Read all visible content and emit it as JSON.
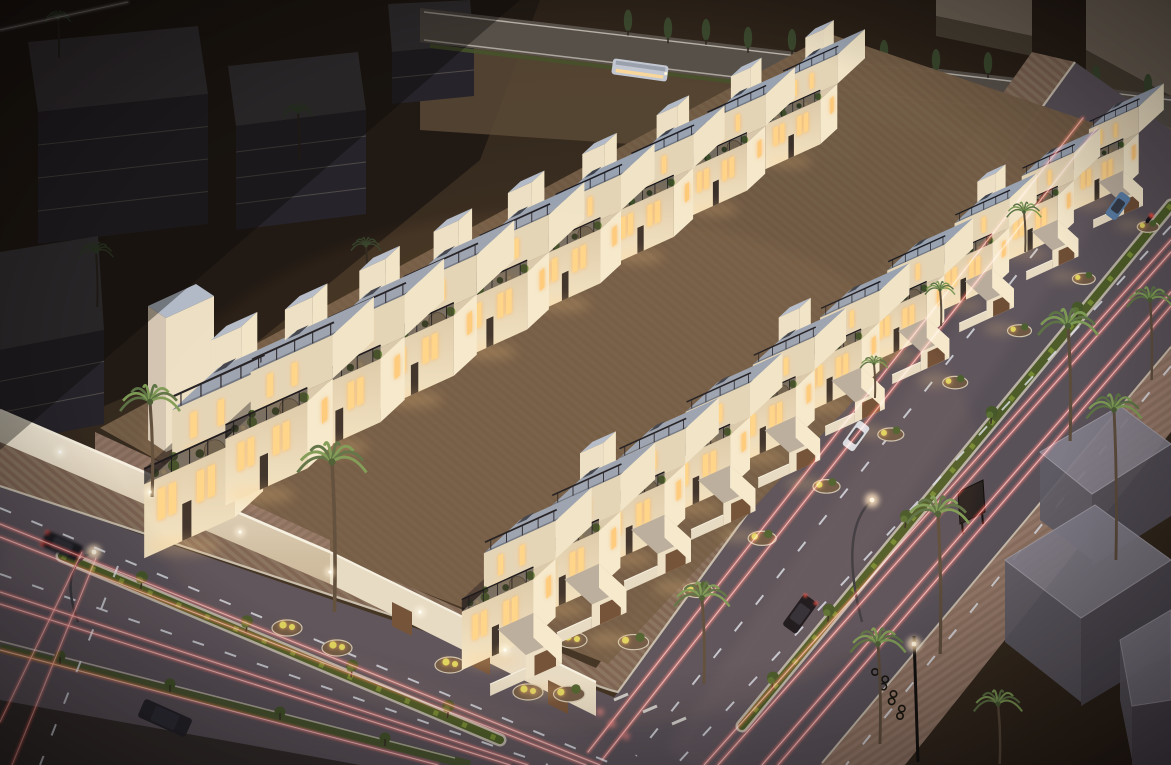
{
  "scene": {
    "label": "Twilight aerial 3D architectural rendering of a white villa townhouse compound with rooftop terraces, palm-lined streets and long-exposure traffic light trails",
    "width": 1171,
    "height": 765,
    "palette": {
      "night": "#17110d",
      "groundWarm": "#463626",
      "groundEdge": "#1a130e",
      "sandTop": "#5c4b37",
      "sandRight": "#392d21",
      "darkCorner": "#1f1913",
      "asphalt": "#595158",
      "asphaltLight": "#6e6268",
      "curb": "#cfc6b6",
      "pav1a": "#7a6151",
      "pav1b": "#85705d",
      "pav2a": "#8a6f5f",
      "pav2b": "#95796a",
      "grass": "#4d5c28",
      "grassLit": "#7c9136",
      "grassCurb": "#b9b2a4",
      "roof": "#99a2b0",
      "roofEdge": "#6e7682",
      "towerTop": "#b2bac7",
      "faceLit": "#ecdfc4",
      "faceMid": "#e4d4b6",
      "sideBright": "#f0e3c6",
      "sideBright2": "#f5e8cb",
      "terrace": "#d8c7aa",
      "wallTop": "#f6efdf",
      "wallFace": "#e7dac2",
      "window": "#ffd488",
      "windowSoft": "#ffc97a",
      "glow": "#ffd9a0",
      "garage": "#6f4e36",
      "entTop": "#b9ac9c",
      "soil": "#6e5844",
      "shrub": "#ded45c",
      "leaf": "#4c612f",
      "leafLit": "#6d8a3d",
      "palmLeaf": "#5d7345",
      "palmLeafLit": "#7d9a55",
      "palmTrunk": "#5c4c3c",
      "palmDark": "#31402a",
      "palmTrunkDark": "#2a241e",
      "cypress": "#39462c",
      "trailRed": "#ff4338",
      "trailCore": "#ffe0d6",
      "trailWhite": "#dfe3ea",
      "bgTop": "#3a373c",
      "bgFront": "#26232a",
      "bgLine": "#5e5952",
      "bgTop2": "#6b6154",
      "bgFront2": "#453d31",
      "ghostTop": "#827e8a",
      "ghostL": "#605c66",
      "ghostF": "#524e58",
      "ghostEdge": "#a09ca6",
      "busBody": "#c2c7d1",
      "busRoof": "#9aa1ad",
      "umbrella": "#c9ae85",
      "carBlack": "#17161b",
      "carWhite": "#d8dade",
      "carBlue": "#5a7ea6",
      "carDark": "#1c1b21",
      "truck": "#26242a"
    },
    "villa_rows": {
      "left": {
        "count": 8,
        "x0": 292,
        "y0": 334,
        "dx": 74,
        "dy": -40,
        "s0": 1.28,
        "ds": -0.06,
        "entrance": false
      },
      "right": {
        "count": 10,
        "x0": 520,
        "y0": 520,
        "dx": 66,
        "dy": -46,
        "s0": 1.12,
        "ds": -0.038,
        "entrance": true
      }
    },
    "corner_villa": {
      "x": 218,
      "y": 368,
      "s": 1.42
    },
    "palms": {
      "compound": [
        [
          150,
          402,
          26,
          95
        ],
        [
          332,
          462,
          30,
          150
        ],
        [
          702,
          598,
          24,
          86
        ],
        [
          1024,
          212,
          15,
          40
        ],
        [
          940,
          290,
          13,
          36
        ],
        [
          874,
          364,
          12,
          34
        ]
      ],
      "right_sidewalk": [
        [
          1068,
          326,
          26,
          115
        ],
        [
          1114,
          410,
          24,
          150
        ],
        [
          938,
          514,
          27,
          140
        ],
        [
          878,
          644,
          24,
          100
        ],
        [
          998,
          704,
          21,
          60
        ],
        [
          1150,
          300,
          20,
          80
        ]
      ],
      "background": [
        [
          96,
          252,
          15,
          55
        ],
        [
          298,
          112,
          13,
          48
        ],
        [
          366,
          246,
          13,
          44
        ],
        [
          58,
          18,
          11,
          40
        ]
      ]
    },
    "cypresses": {
      "xs": [
        628,
        668,
        706,
        748,
        792,
        838,
        884,
        936,
        988,
        1042,
        1096,
        1148
      ],
      "y_base": 6,
      "slope": 0.118,
      "lift": 10
    },
    "median_trees": {
      "right": [
        0.22,
        0.42,
        0.62,
        0.8,
        0.93
      ],
      "left": [
        0.18,
        0.42,
        0.66,
        0.88
      ]
    },
    "trails": {
      "right_red": [
        [
          [
            1083,
            118
          ],
          [
            588,
            752
          ]
        ],
        [
          [
            1097,
            128
          ],
          [
            602,
            760
          ]
        ],
        [
          [
            1171,
            240
          ],
          [
            704,
            765
          ]
        ],
        [
          [
            1171,
            252
          ],
          [
            718,
            765
          ]
        ],
        [
          [
            1171,
            292
          ],
          [
            762,
            765
          ]
        ],
        [
          [
            1171,
            306
          ],
          [
            778,
            765
          ]
        ]
      ],
      "right_white": [
        [
          [
            1122,
            142
          ],
          [
            636,
            756
          ]
        ],
        [
          [
            1171,
            226
          ],
          [
            676,
            765
          ]
        ],
        [
          [
            1171,
            366
          ],
          [
            846,
            765
          ]
        ]
      ],
      "left_red": [
        [
          [
            0,
            524
          ],
          [
            600,
            765
          ]
        ],
        [
          [
            0,
            537
          ],
          [
            586,
            765
          ]
        ],
        [
          [
            0,
            592
          ],
          [
            528,
            765
          ]
        ],
        [
          [
            0,
            604
          ],
          [
            510,
            765
          ]
        ],
        [
          [
            0,
            650
          ],
          [
            438,
            765
          ]
        ]
      ],
      "left_white": [
        [
          [
            0,
            508
          ],
          [
            608,
            762
          ]
        ],
        [
          [
            0,
            574
          ],
          [
            548,
            765
          ]
        ]
      ],
      "corner_red": [
        [
          [
            96,
            558
          ],
          [
            12,
            765
          ]
        ],
        [
          [
            82,
            552
          ],
          [
            0,
            722
          ]
        ]
      ],
      "corner_white": [
        [
          [
            118,
            566
          ],
          [
            40,
            765
          ]
        ]
      ],
      "top_left_white": [
        [
          [
            0,
            30
          ],
          [
            128,
            2
          ]
        ]
      ]
    },
    "brake_lights": [
      [
        612,
        724
      ],
      [
        626,
        736
      ],
      [
        600,
        712
      ]
    ],
    "wall_lights": [
      [
        60,
        452
      ],
      [
        150,
        492
      ],
      [
        240,
        532
      ],
      [
        330,
        572
      ],
      [
        420,
        612
      ],
      [
        505,
        650
      ]
    ],
    "lamp_glows": [
      [
        94,
        552
      ],
      [
        872,
        500
      ],
      [
        914,
        644
      ]
    ],
    "cars": [
      {
        "kind": "car-white",
        "x": 856,
        "y": 436,
        "rot": 126,
        "l": 30,
        "w": 14,
        "body": "carWhite",
        "brake": false
      },
      {
        "kind": "car-black",
        "x": 800,
        "y": 614,
        "rot": 126,
        "l": 38,
        "w": 17,
        "body": "carBlack",
        "brake": true
      },
      {
        "kind": "van-blue",
        "x": 1118,
        "y": 206,
        "rot": 126,
        "l": 28,
        "w": 13,
        "body": "carBlue",
        "brake": false
      },
      {
        "kind": "motorcycle",
        "x": 1149,
        "y": 219,
        "rot": 126,
        "l": 10,
        "w": 4,
        "body": "carBlack",
        "brake": true
      },
      {
        "kind": "car-dark-blurred",
        "x": 62,
        "y": 546,
        "rot": 24,
        "l": 40,
        "w": 17,
        "body": "carDark",
        "brake": true,
        "blur": true
      },
      {
        "kind": "truck-dark",
        "x": 165,
        "y": 718,
        "rot": 24,
        "l": 52,
        "w": 20,
        "body": "truck",
        "brake": false
      }
    ],
    "bus": {
      "x": 640,
      "y": 70,
      "rot": 8,
      "l": 56,
      "w": 16
    },
    "billboard": {
      "pts": [
        [
          958,
          492
        ],
        [
          983,
          480
        ],
        [
          985,
          512
        ],
        [
          960,
          524
        ]
      ]
    },
    "bike_racks": {
      "from": [
        878,
        672
      ],
      "to": [
        903,
        716
      ],
      "count": 7
    },
    "background_buildings": [
      {
        "top": [
          [
            28,
            42
          ],
          [
            198,
            26
          ],
          [
            208,
            94
          ],
          [
            38,
            112
          ]
        ],
        "front": [
          [
            38,
            112
          ],
          [
            208,
            94
          ],
          [
            208,
            224
          ],
          [
            38,
            244
          ]
        ],
        "t": "bgTop",
        "f": "bgFront",
        "lines": 3
      },
      {
        "top": [
          [
            228,
            66
          ],
          [
            358,
            52
          ],
          [
            366,
            110
          ],
          [
            236,
            126
          ]
        ],
        "front": [
          [
            236,
            126
          ],
          [
            366,
            110
          ],
          [
            366,
            214
          ],
          [
            236,
            230
          ]
        ],
        "t": "bgTop",
        "f": "bgFront",
        "lines": 3
      },
      {
        "top": [
          [
            0,
            252
          ],
          [
            98,
            236
          ],
          [
            104,
            330
          ],
          [
            0,
            350
          ]
        ],
        "front": [
          [
            0,
            350
          ],
          [
            104,
            330
          ],
          [
            104,
            424
          ],
          [
            0,
            444
          ]
        ],
        "t": "bgTop",
        "f": "bgFront",
        "lines": 2
      },
      {
        "top": [
          [
            388,
            4
          ],
          [
            470,
            0
          ],
          [
            474,
            44
          ],
          [
            392,
            52
          ]
        ],
        "front": [
          [
            392,
            52
          ],
          [
            474,
            44
          ],
          [
            474,
            96
          ],
          [
            392,
            104
          ]
        ],
        "t": "bgTop",
        "f": "bgFront",
        "lines": 1
      },
      {
        "top": [
          [
            1086,
            0
          ],
          [
            1171,
            0
          ],
          [
            1171,
            96
          ],
          [
            1086,
            50
          ]
        ],
        "front": [
          [
            1086,
            50
          ],
          [
            1171,
            96
          ],
          [
            1171,
            128
          ],
          [
            1086,
            84
          ]
        ],
        "t": "bgTop2",
        "f": "bgFront2",
        "lines": 0
      },
      {
        "top": [
          [
            936,
            0
          ],
          [
            1032,
            0
          ],
          [
            1032,
            36
          ],
          [
            936,
            16
          ]
        ],
        "front": [
          [
            936,
            16
          ],
          [
            1032,
            36
          ],
          [
            1032,
            56
          ],
          [
            936,
            36
          ]
        ],
        "t": "bgTop2",
        "f": "bgFront2",
        "lines": 0
      }
    ],
    "ghost_buildings": [
      {
        "top": [
          [
            1040,
            452
          ],
          [
            1120,
            406
          ],
          [
            1171,
            444
          ],
          [
            1092,
            494
          ]
        ],
        "left": [
          [
            1040,
            452
          ],
          [
            1092,
            494
          ],
          [
            1092,
            560
          ],
          [
            1040,
            520
          ]
        ],
        "front": [
          [
            1092,
            494
          ],
          [
            1171,
            444
          ],
          [
            1171,
            516
          ],
          [
            1092,
            566
          ]
        ]
      },
      {
        "top": [
          [
            1005,
            560
          ],
          [
            1095,
            505
          ],
          [
            1171,
            560
          ],
          [
            1081,
            618
          ]
        ],
        "left": [
          [
            1005,
            560
          ],
          [
            1081,
            618
          ],
          [
            1081,
            702
          ],
          [
            1005,
            642
          ]
        ],
        "front": [
          [
            1081,
            618
          ],
          [
            1171,
            560
          ],
          [
            1171,
            652
          ],
          [
            1081,
            706
          ]
        ]
      },
      {
        "top": [
          [
            1120,
            640
          ],
          [
            1171,
            610
          ],
          [
            1171,
            700
          ],
          [
            1132,
            706
          ]
        ],
        "left": [
          [
            1120,
            640
          ],
          [
            1132,
            706
          ],
          [
            1132,
            760
          ],
          [
            1120,
            700
          ]
        ],
        "front": [
          [
            1132,
            706
          ],
          [
            1171,
            700
          ],
          [
            1171,
            765
          ],
          [
            1132,
            765
          ]
        ]
      }
    ]
  }
}
